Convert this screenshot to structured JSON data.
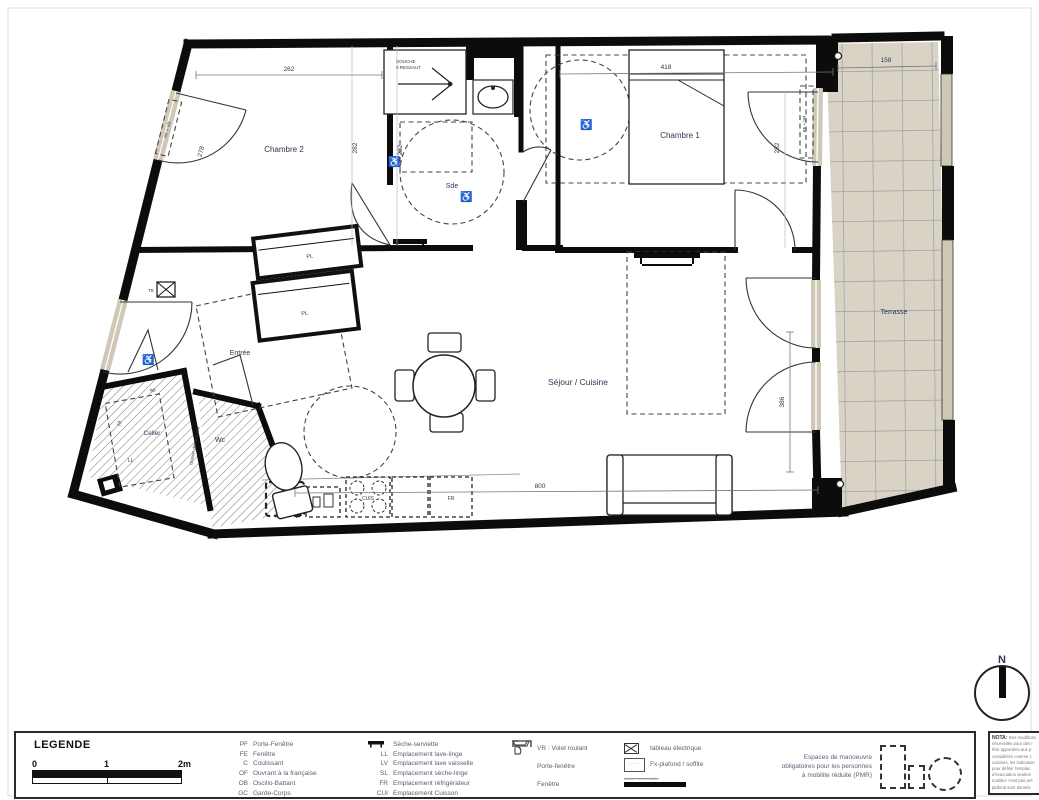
{
  "plan": {
    "rooms": {
      "chambre2": "Chambre 2",
      "chambre1": "Chambre 1",
      "sde": "Sde",
      "entree": "Entrée",
      "cellier": "Celler",
      "wc": "Wc",
      "sejour": "Séjour / Cuisine",
      "terrasse": "Terrasse"
    },
    "dims": {
      "d262": "262",
      "d418": "418",
      "d158": "158",
      "d278": "278",
      "d282_chambre2": "282",
      "d282_sde": "282",
      "d282_chambre1": "282",
      "d386": "386",
      "d800": "800",
      "d90": "90",
      "d79": "79"
    },
    "annotations": {
      "douche_line1": "DOUCHE",
      "douche_line2": "0 RESSAUT",
      "pl1": "PL",
      "pl2": "PL",
      "fr": "FR",
      "cuis": "CUIS",
      "ll": "LL",
      "te": "TE",
      "cloison": "cloison démontable",
      "window_left": "PF + VR",
      "window_right": "PF + VR",
      "wheelchair": "♿",
      "north": "N"
    }
  },
  "legend": {
    "title": "LEGENDE",
    "scale": {
      "t0": "0",
      "t1": "1",
      "t2": "2m"
    },
    "abbreviations": [
      {
        "abbr": "PF",
        "label": "Porte-Fenêtre"
      },
      {
        "abbr": "FE",
        "label": "Fenêtre"
      },
      {
        "abbr": "C",
        "label": "Coulissant"
      },
      {
        "abbr": "OF",
        "label": "Ouvrant à la française"
      },
      {
        "abbr": "OB",
        "label": "Oscillo-Battant"
      },
      {
        "abbr": "GC",
        "label": "Garde-Corps"
      }
    ],
    "equipment": [
      {
        "abbr": "",
        "label": "Sèche-serviette"
      },
      {
        "abbr": "LL",
        "label": "Emplacement lave-linge"
      },
      {
        "abbr": "LV",
        "label": "Emplacement lave vaisselle"
      },
      {
        "abbr": "SL",
        "label": "Emplacement sèche-linge"
      },
      {
        "abbr": "FR",
        "label": "Emplacement réfrigérateur"
      },
      {
        "abbr": "CUI",
        "label": "Emplacement Cuisson"
      }
    ],
    "symbols": [
      {
        "label": "VR : Volet roulant"
      },
      {
        "label": "Porte-fenêtre"
      },
      {
        "label": "Fenêtre"
      }
    ],
    "symbols2": [
      {
        "label": "tableau électrique"
      },
      {
        "label": "Fx-plafond / soffite"
      },
      {
        "label": "cloison démontable"
      }
    ],
    "pmr_line1": "Espaces de manoeuvre",
    "pmr_line2": "obligatoires pour les personnes",
    "pmr_line3": "à mobilite réduite (PMR)"
  },
  "nota": {
    "title": "NOTA:",
    "lines": [
      "Des modificati",
      "nécessités pour des r",
      "être apportées aux p",
      "considérée comme c",
      "cuisines, les indication",
      "pour définir l'emplac",
      "d'évacuation seulem",
      "mobilier n'est pas pré",
      "plafond sont donnée"
    ]
  }
}
